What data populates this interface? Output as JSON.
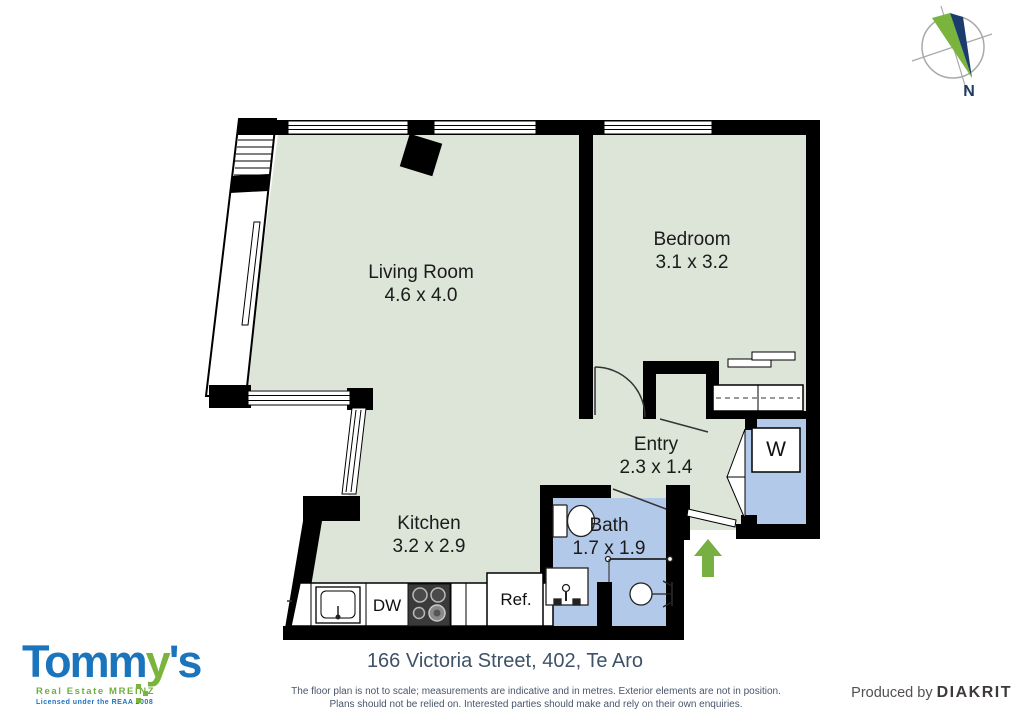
{
  "plan": {
    "rooms": [
      {
        "id": "living",
        "name": "Living Room",
        "dims": "4.6 x 4.0"
      },
      {
        "id": "bedroom",
        "name": "Bedroom",
        "dims": "3.1 x 3.2"
      },
      {
        "id": "kitchen",
        "name": "Kitchen",
        "dims": "3.2 x 2.9"
      },
      {
        "id": "bath",
        "name": "Bath",
        "dims": "1.7 x 1.9"
      },
      {
        "id": "entry",
        "name": "Entry",
        "dims": "2.3 x 1.4"
      }
    ],
    "fixtures": {
      "dishwasher": "DW",
      "refrigerator": "Ref.",
      "washer": "W"
    },
    "compass_label": "N"
  },
  "footer": {
    "address": "166 Victoria Street, 402, Te Aro",
    "disclaimer_line1": "The floor plan is not to scale; measurements are indicative and in metres. Exterior elements are not in position.",
    "disclaimer_line2": "Plans should not be relied on. Interested parties should make and rely on their own enquiries.",
    "produced_by": "Produced by ",
    "producer": "DIAKRIT"
  },
  "logo": {
    "brand_part1": "Tomm",
    "brand_part2": "y",
    "brand_part3": "'s",
    "tagline": "Real Estate MREINZ",
    "license": "Licensed under the REAA 2008"
  },
  "colors": {
    "floor_green": "#dde4d8",
    "wet_blue": "#b3c9e9",
    "wall_black": "#000000",
    "arrow_green": "#76b043",
    "brand_blue": "#1b75bc",
    "brand_green": "#7ab43c",
    "compass_navy": "#1b3d6e",
    "text_slate": "#3f5268"
  }
}
